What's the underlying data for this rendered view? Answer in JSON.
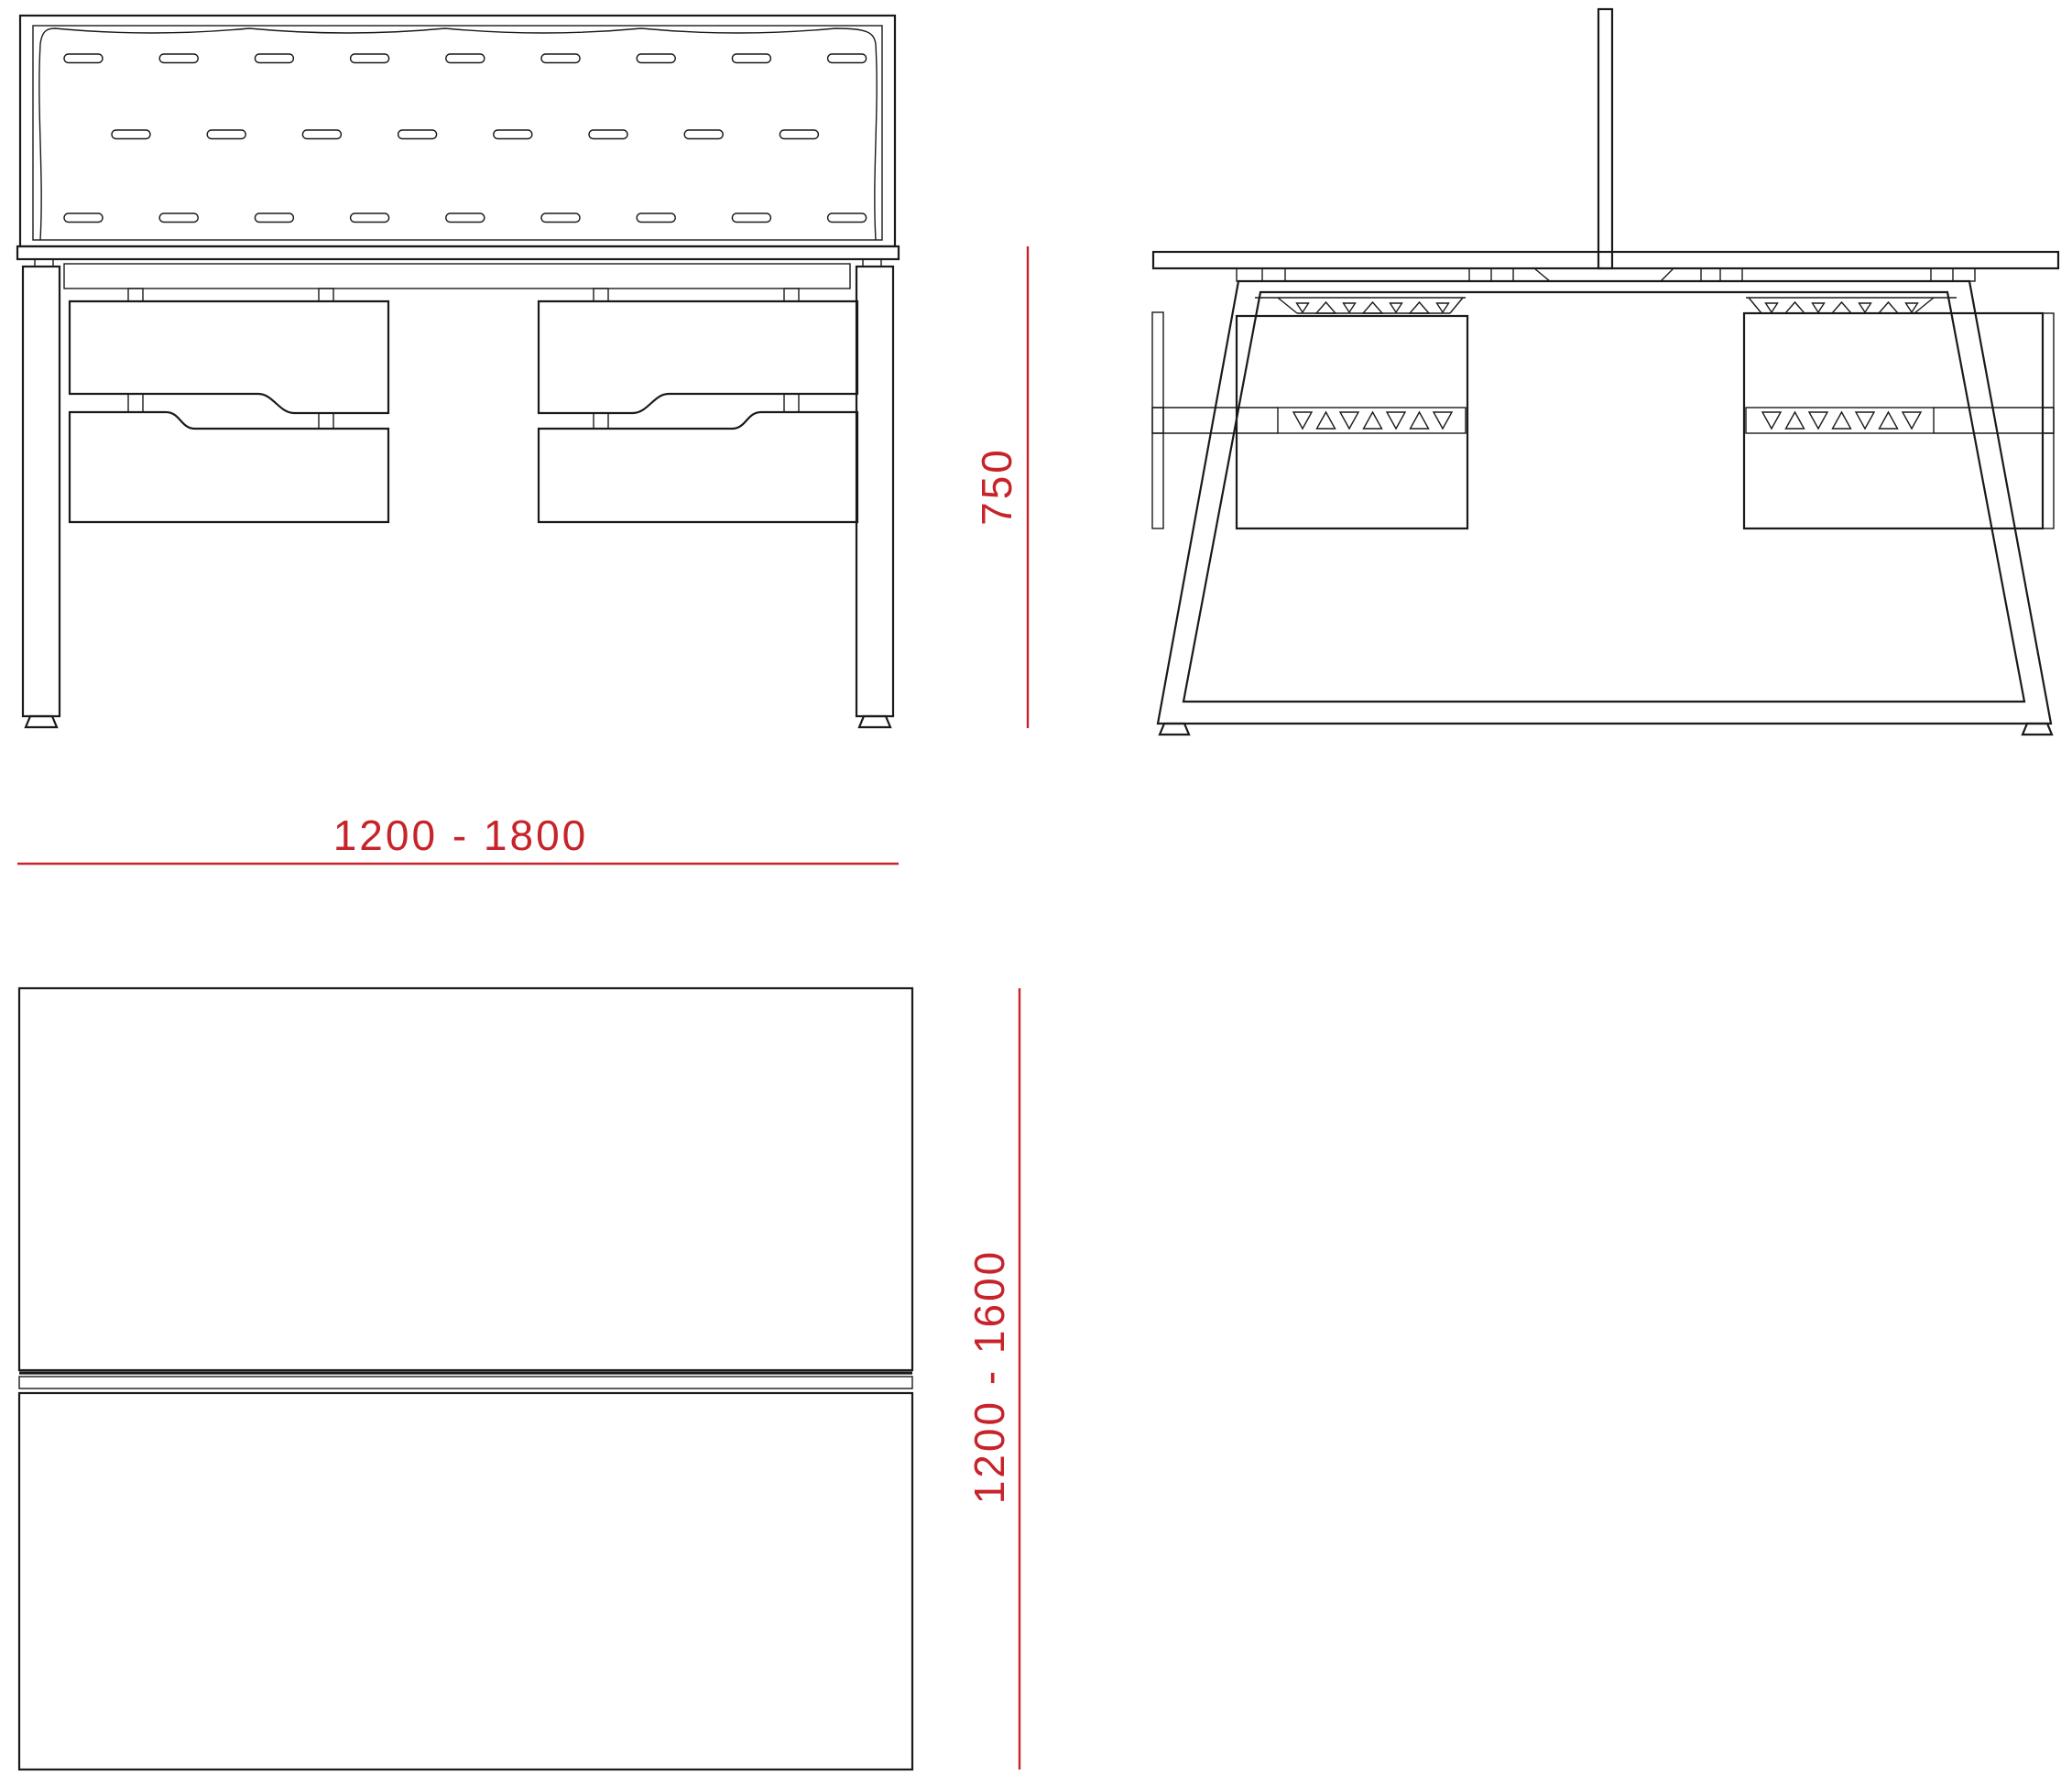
{
  "drawing": {
    "background_color": "#ffffff",
    "line_color": "#1a1a1a",
    "accent_color": "#c7232a",
    "dimensions": {
      "height": {
        "label": "750"
      },
      "width": {
        "label": "1200 - 1800"
      },
      "depth": {
        "label": "1200 - 1600"
      }
    }
  }
}
